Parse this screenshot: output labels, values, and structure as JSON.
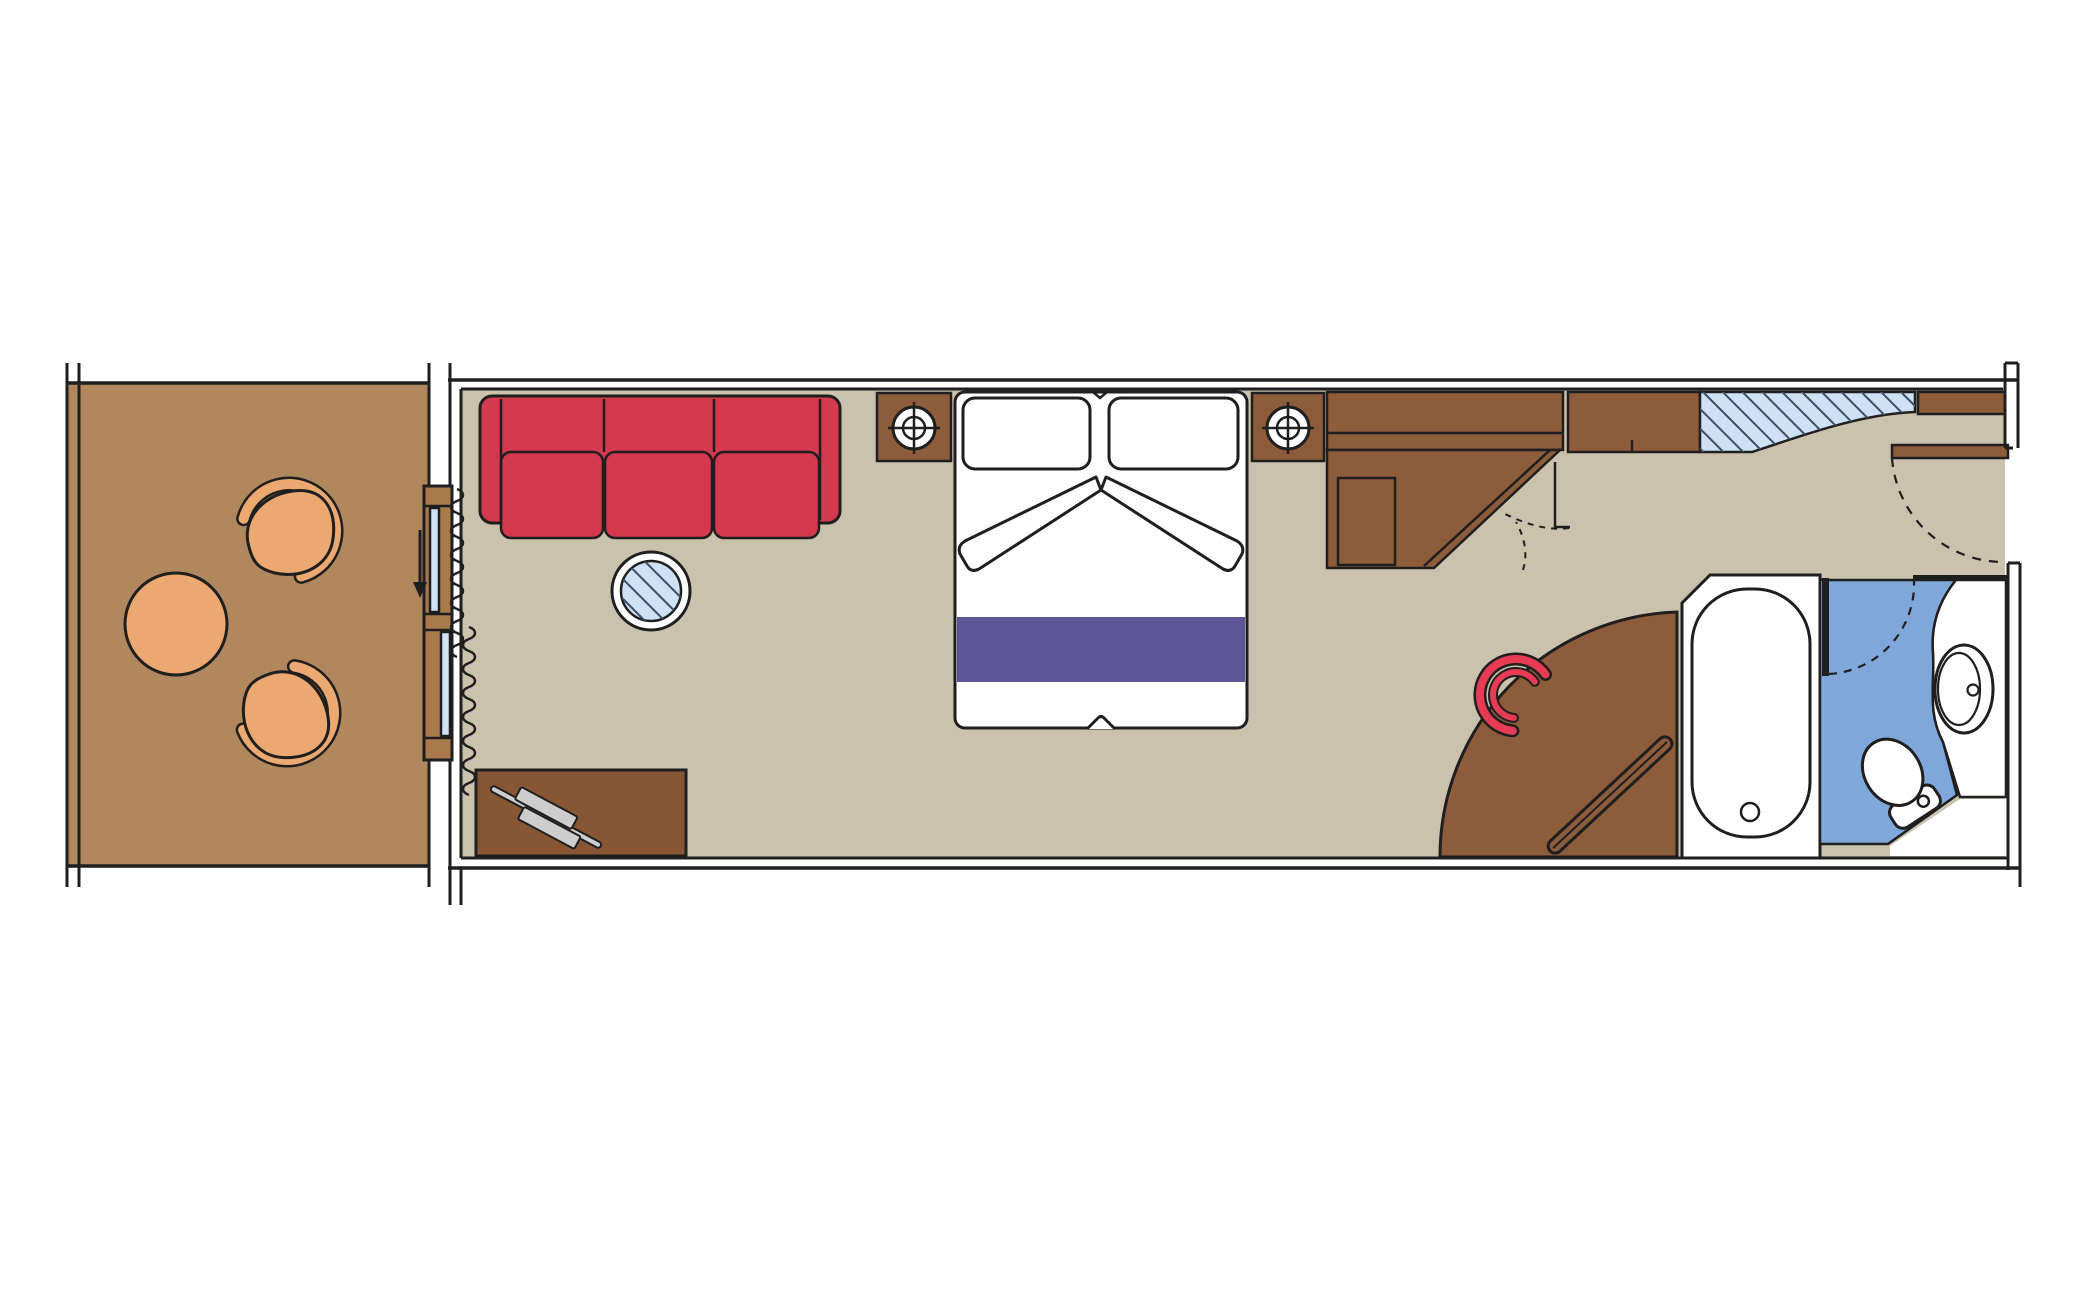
{
  "title": "Stateroom floor plan with private balcony",
  "palette": {
    "outline": "#1f1f1f",
    "balcony_floor": "#b1875d",
    "furniture_tan": "#eca871",
    "cabin_floor": "#cbc2ad",
    "wood": "#8d5c3a",
    "wood_dark": "#875634",
    "wood_light": "#a87a4c",
    "red": "#d4394f",
    "red_bright": "#e73a55",
    "purple": "#5d5596",
    "glass": "#cfe1f5",
    "glass_hatch": "#3f4e68",
    "bath_blue": "#7fa7da",
    "white": "#ffffff"
  },
  "rooms": [
    {
      "id": "balcony",
      "name": "Balcony"
    },
    {
      "id": "cabin",
      "name": "Living and sleeping area"
    },
    {
      "id": "entry",
      "name": "Entrance vestibule"
    },
    {
      "id": "bathroom",
      "name": "Bathroom"
    }
  ],
  "furniture": [
    {
      "name": "armchair",
      "room": "balcony",
      "count": 2
    },
    {
      "name": "round-table",
      "room": "balcony",
      "count": 1
    },
    {
      "name": "sliding-glass-door",
      "room": "balcony",
      "count": 1
    },
    {
      "name": "curtain",
      "room": "cabin",
      "count": 1
    },
    {
      "name": "three-seat-sofa",
      "room": "cabin",
      "count": 1
    },
    {
      "name": "glass-coffee-table",
      "room": "cabin",
      "count": 1
    },
    {
      "name": "sideboard-desk",
      "room": "cabin",
      "count": 1
    },
    {
      "name": "double-bed-with-runner",
      "room": "cabin",
      "count": 1
    },
    {
      "name": "nightstand-with-lamp",
      "room": "cabin",
      "count": 2
    },
    {
      "name": "wardrobe-with-safe",
      "room": "cabin",
      "count": 1
    },
    {
      "name": "minibar-cabinet",
      "room": "cabin",
      "count": 1
    },
    {
      "name": "mirror-panel",
      "room": "cabin",
      "count": 1
    },
    {
      "name": "entry-shelf",
      "room": "entry",
      "count": 1
    },
    {
      "name": "entrance-door",
      "room": "entry",
      "count": 1
    },
    {
      "name": "curved-vanity-desk",
      "room": "cabin",
      "count": 1
    },
    {
      "name": "stool",
      "room": "cabin",
      "count": 1
    },
    {
      "name": "towel-rail",
      "room": "cabin",
      "count": 1
    },
    {
      "name": "bathtub",
      "room": "bathroom",
      "count": 1
    },
    {
      "name": "washbasin",
      "room": "bathroom",
      "count": 1
    },
    {
      "name": "toilet",
      "room": "bathroom",
      "count": 1
    },
    {
      "name": "bathroom-door",
      "room": "bathroom",
      "count": 1
    }
  ]
}
